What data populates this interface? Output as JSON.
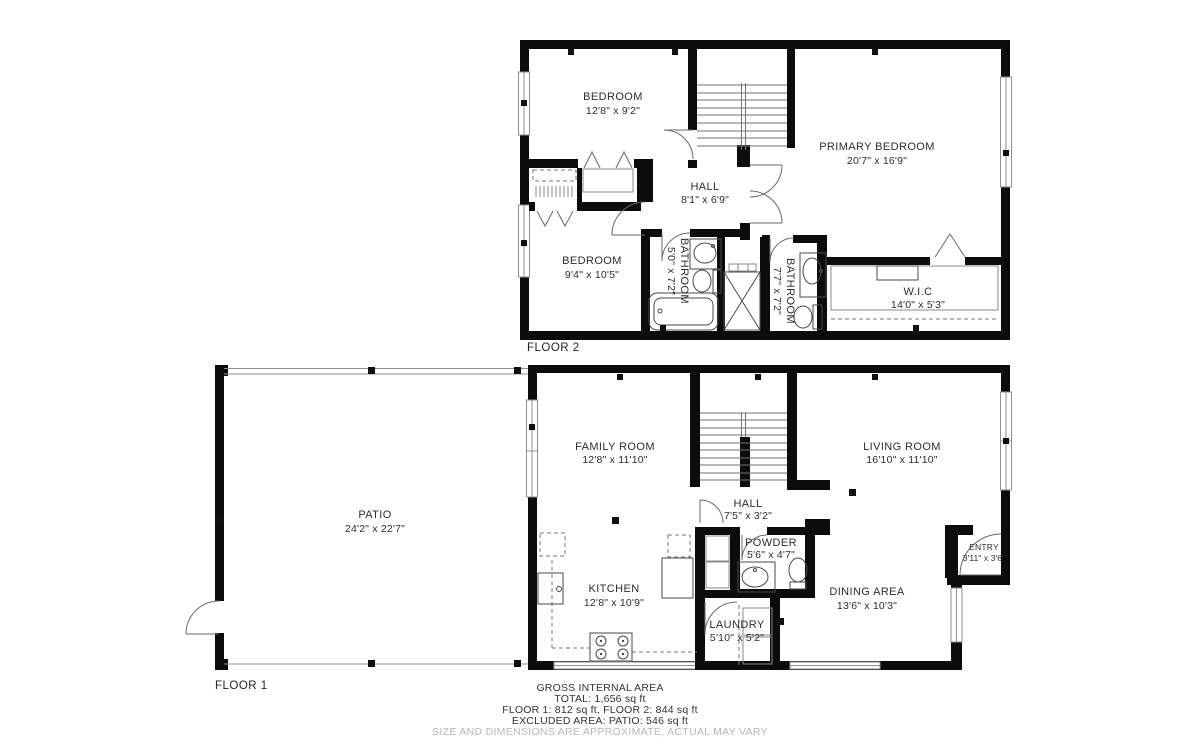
{
  "floor2": {
    "label": "FLOOR 2",
    "rooms": [
      {
        "name": "BEDROOM",
        "dims": "12'8\" x 9'2\""
      },
      {
        "name": "PRIMARY BEDROOM",
        "dims": "20'7\" x 16'9\""
      },
      {
        "name": "HALL",
        "dims": "8'1\" x 6'9\""
      },
      {
        "name": "BEDROOM",
        "dims": "9'4\" x 10'5\""
      },
      {
        "name": "BATHROOM",
        "dims": "5'0\" x 7'2\""
      },
      {
        "name": "BATHROOM",
        "dims": "7'7\" x 7'2\""
      },
      {
        "name": "W.I.C",
        "dims": "14'0\" x 5'3\""
      }
    ]
  },
  "floor1": {
    "label": "FLOOR 1",
    "rooms": [
      {
        "name": "PATIO",
        "dims": "24'2\" x 22'7\""
      },
      {
        "name": "FAMILY ROOM",
        "dims": "12'8\" x 11'10\""
      },
      {
        "name": "LIVING ROOM",
        "dims": "16'10\" x 11'10\""
      },
      {
        "name": "HALL",
        "dims": "7'5\" x 3'2\""
      },
      {
        "name": "POWDER",
        "dims": "5'6\" x 4'7\""
      },
      {
        "name": "KITCHEN",
        "dims": "12'8\" x 10'9\""
      },
      {
        "name": "DINING AREA",
        "dims": "13'6\" x 10'3\""
      },
      {
        "name": "ENTRY",
        "dims": "3'11\" x 3'6\""
      },
      {
        "name": "LAUNDRY",
        "dims": "5'10\" x 5'2\""
      }
    ]
  },
  "footer": {
    "title": "GROSS INTERNAL AREA",
    "total": "TOTAL: 1,656 sq ft",
    "floors": "FLOOR 1: 812 sq ft, FLOOR 2: 844 sq ft",
    "excluded": "EXCLUDED AREA: PATIO: 546 sq ft",
    "disclaimer": "SIZE AND DIMENSIONS ARE APPROXIMATE, ACTUAL MAY VARY"
  }
}
